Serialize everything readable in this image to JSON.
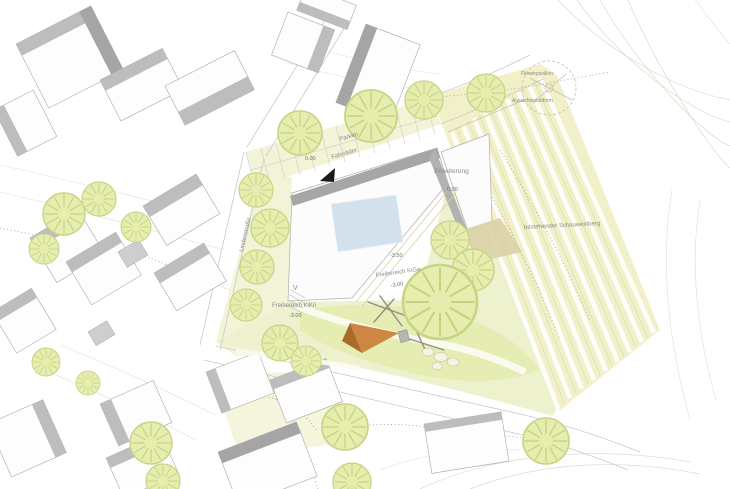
{
  "plan": {
    "labels": {
      "street": "Lindenstraße",
      "parken": "Parken",
      "fahrraeder": "Fahrräder",
      "entry_level": "0.00",
      "storeys": "V",
      "erweiterung": "Erweiterung",
      "erweiterung_level": "0.00",
      "spot_level": "-3.50",
      "kikri": "Freibereich KiKri",
      "kikri_level": "-3.00",
      "kiga": "Freibereich KiGa",
      "kiga_level": "-3.00",
      "weinberg": "bestehender Schauweinberg",
      "pavillon": "Flowerpavillon",
      "plattform": "Aussichtsplattform"
    },
    "colors": {
      "ground_yellow": "#f3f3d7",
      "green_area": "#e3ecae",
      "tree_fill": "#e6edaf",
      "tree_stroke": "#c6d484",
      "roof_gray": "#bdbdbd",
      "building_white": "#fdfdfd",
      "skylight_blue": "#d2e1ec",
      "play_orange": "#cd8743",
      "contour_tan": "#dcd7c6",
      "entry_arrow": "#1a1a1a"
    }
  }
}
